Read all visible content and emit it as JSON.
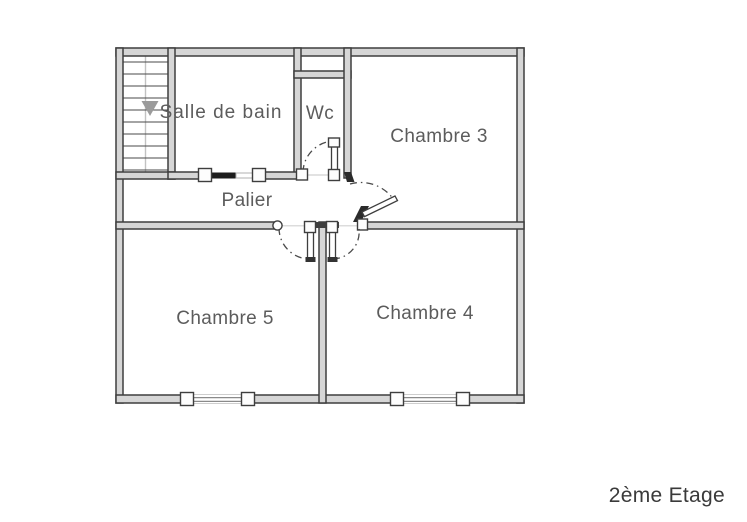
{
  "floor_title": "2ème Etage",
  "rooms": {
    "salle_de_bain": "Salle de bain",
    "wc": "Wc",
    "chambre_3": "Chambre 3",
    "palier": "Palier",
    "chambre_5": "Chambre 5",
    "chambre_4": "Chambre 4"
  },
  "colors": {
    "wall_stroke": "#3e3e3e",
    "wall_fill": "#d6d6d6",
    "room_label": "#5c5c5c",
    "title": "#3a3a3a",
    "stair_arrow": "#9b9b9b"
  },
  "icons": {
    "stairs_direction": "down-arrow"
  }
}
